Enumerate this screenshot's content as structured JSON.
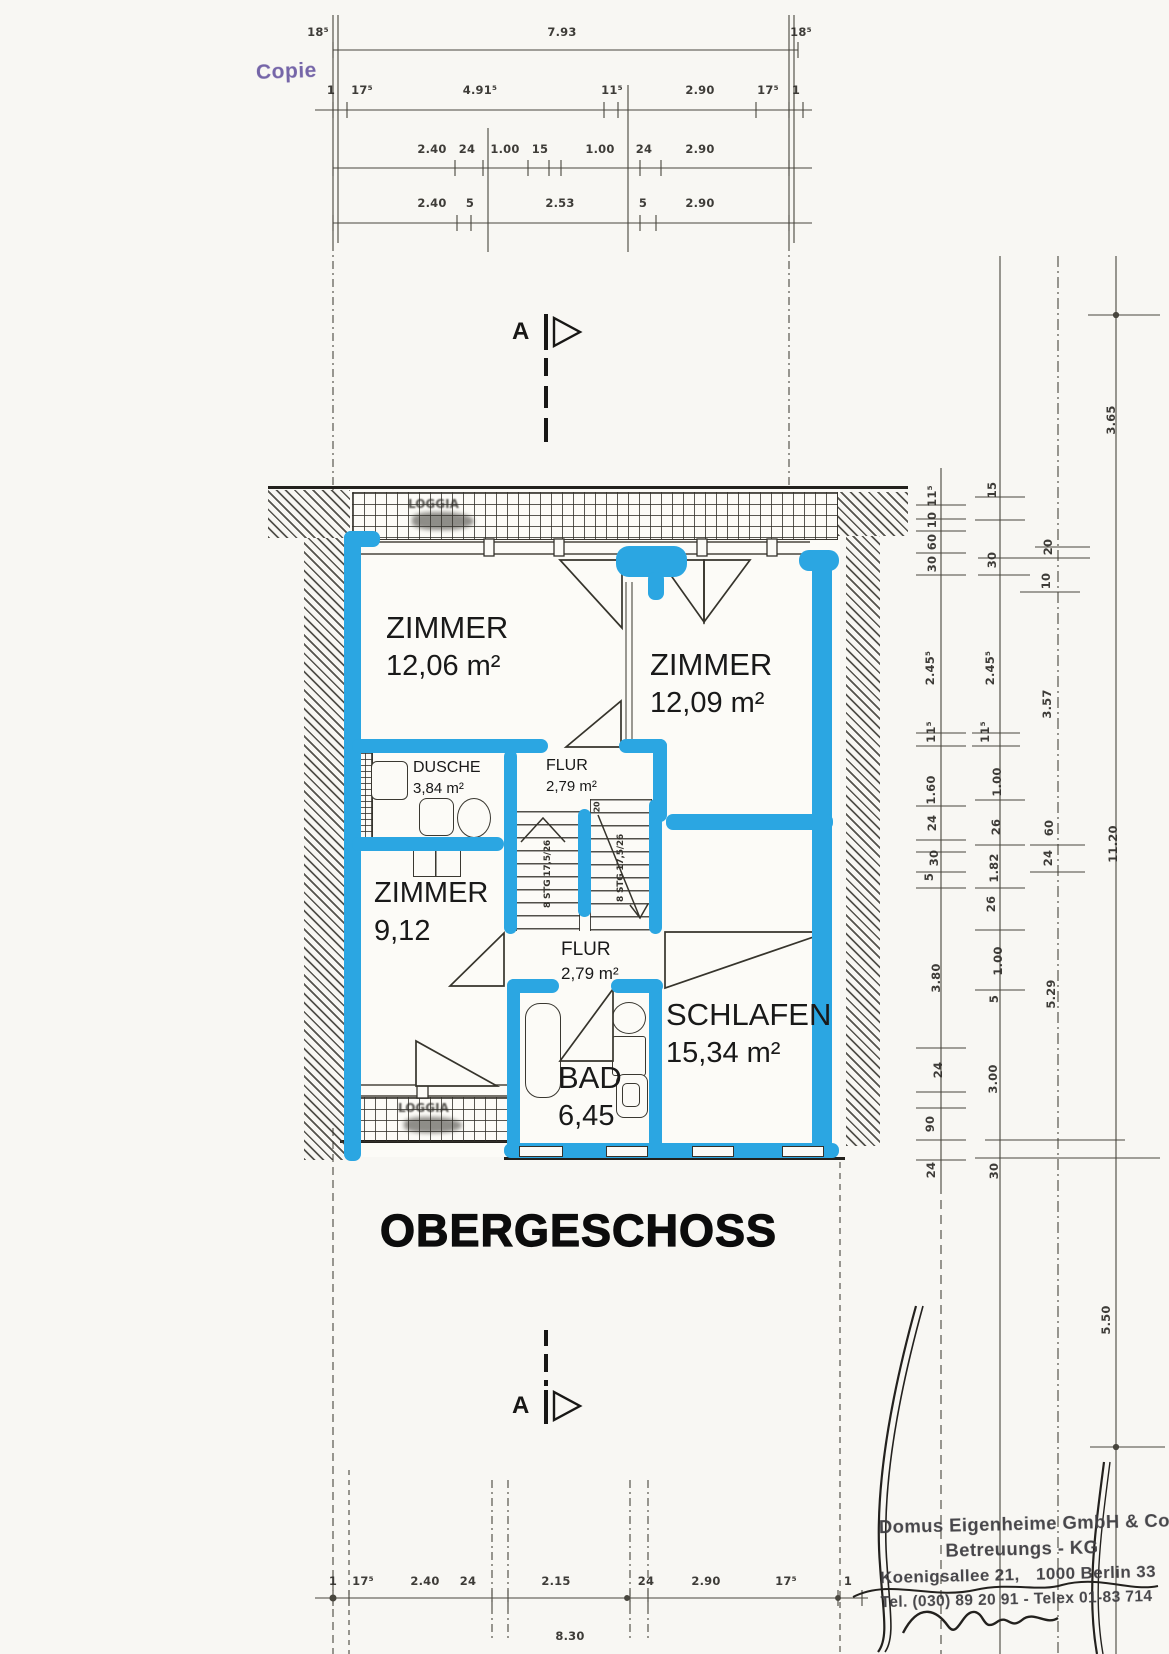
{
  "meta": {
    "copie_label": "Copie",
    "plan_title": "OBERGESCHOSS",
    "section_marker": "A"
  },
  "colors": {
    "highlight_blue": "#2ba6e2",
    "copie_purple": "#7565a8",
    "ink": "#34322c"
  },
  "rooms": {
    "zimmer1": {
      "name": "ZIMMER",
      "area": "12,06 m²"
    },
    "zimmer2": {
      "name": "ZIMMER",
      "area": "12,09 m²"
    },
    "dusche": {
      "name": "DUSCHE",
      "area": "3,84 m²"
    },
    "flur1": {
      "name": "FLUR",
      "area": "2,79 m²"
    },
    "zimmer3": {
      "name": "ZIMMER",
      "area": "9,12"
    },
    "flur2": {
      "name": "FLUR",
      "area": "2,79 m²"
    },
    "schlafen": {
      "name": "SCHLAFEN",
      "area": "15,34 m²"
    },
    "bad": {
      "name": "BAD",
      "area": "6,45"
    }
  },
  "loggia": {
    "top_label": "LOGGIA",
    "bottom_label": "LOGGIA",
    "unit": "m²"
  },
  "stairs": {
    "flight1": "8 STG 17,5/26",
    "flight2": "8 STG 17,5/26",
    "tread_note": "20"
  },
  "dims": {
    "top_labels": [
      {
        "x": 318,
        "y": 32,
        "t": "18⁵"
      },
      {
        "x": 562,
        "y": 32,
        "t": "7.93"
      },
      {
        "x": 801,
        "y": 32,
        "t": "18⁵"
      },
      {
        "x": 331,
        "y": 90,
        "t": "1"
      },
      {
        "x": 362,
        "y": 90,
        "t": "17⁵"
      },
      {
        "x": 480,
        "y": 90,
        "t": "4.91⁵"
      },
      {
        "x": 612,
        "y": 90,
        "t": "11⁵"
      },
      {
        "x": 700,
        "y": 90,
        "t": "2.90"
      },
      {
        "x": 768,
        "y": 90,
        "t": "17⁵"
      },
      {
        "x": 796,
        "y": 90,
        "t": "1"
      },
      {
        "x": 432,
        "y": 149,
        "t": "2.40"
      },
      {
        "x": 467,
        "y": 149,
        "t": "24"
      },
      {
        "x": 505,
        "y": 149,
        "t": "1.00"
      },
      {
        "x": 540,
        "y": 149,
        "t": "15"
      },
      {
        "x": 600,
        "y": 149,
        "t": "1.00"
      },
      {
        "x": 644,
        "y": 149,
        "t": "24"
      },
      {
        "x": 700,
        "y": 149,
        "t": "2.90"
      },
      {
        "x": 432,
        "y": 203,
        "t": "2.40"
      },
      {
        "x": 470,
        "y": 203,
        "t": "5"
      },
      {
        "x": 560,
        "y": 203,
        "t": "2.53"
      },
      {
        "x": 643,
        "y": 203,
        "t": "5"
      },
      {
        "x": 700,
        "y": 203,
        "t": "2.90"
      }
    ],
    "right_labels": [
      {
        "x": 932,
        "y": 496,
        "t": "11⁵"
      },
      {
        "x": 932,
        "y": 520,
        "t": "10"
      },
      {
        "x": 932,
        "y": 542,
        "t": "60"
      },
      {
        "x": 932,
        "y": 564,
        "t": "30"
      },
      {
        "x": 930,
        "y": 668,
        "t": "2.45⁵"
      },
      {
        "x": 931,
        "y": 732,
        "t": "11⁵"
      },
      {
        "x": 931,
        "y": 790,
        "t": "1.60"
      },
      {
        "x": 932,
        "y": 823,
        "t": "24"
      },
      {
        "x": 934,
        "y": 858,
        "t": "30"
      },
      {
        "x": 929,
        "y": 877,
        "t": "5"
      },
      {
        "x": 936,
        "y": 978,
        "t": "3.80"
      },
      {
        "x": 938,
        "y": 1070,
        "t": "24"
      },
      {
        "x": 930,
        "y": 1124,
        "t": "90"
      },
      {
        "x": 931,
        "y": 1170,
        "t": "24"
      },
      {
        "x": 992,
        "y": 490,
        "t": "15"
      },
      {
        "x": 992,
        "y": 560,
        "t": "30"
      },
      {
        "x": 990,
        "y": 668,
        "t": "2.45⁵"
      },
      {
        "x": 985,
        "y": 732,
        "t": "11⁵"
      },
      {
        "x": 997,
        "y": 782,
        "t": "1.00"
      },
      {
        "x": 996,
        "y": 827,
        "t": "26"
      },
      {
        "x": 994,
        "y": 868,
        "t": "1.82"
      },
      {
        "x": 991,
        "y": 904,
        "t": "26"
      },
      {
        "x": 998,
        "y": 961,
        "t": "1.00"
      },
      {
        "x": 994,
        "y": 999,
        "t": "5"
      },
      {
        "x": 993,
        "y": 1079,
        "t": "3.00"
      },
      {
        "x": 994,
        "y": 1171,
        "t": "30"
      },
      {
        "x": 1048,
        "y": 547,
        "t": "20"
      },
      {
        "x": 1046,
        "y": 581,
        "t": "10"
      },
      {
        "x": 1047,
        "y": 704,
        "t": "3.57"
      },
      {
        "x": 1049,
        "y": 828,
        "t": "60"
      },
      {
        "x": 1048,
        "y": 858,
        "t": "24"
      },
      {
        "x": 1051,
        "y": 994,
        "t": "5.29"
      },
      {
        "x": 1111,
        "y": 420,
        "t": "3.65"
      },
      {
        "x": 1113,
        "y": 844,
        "t": "11.20"
      },
      {
        "x": 1106,
        "y": 1320,
        "t": "5.50"
      }
    ],
    "bottom_labels": [
      {
        "x": 333,
        "y": 1581,
        "t": "1"
      },
      {
        "x": 363,
        "y": 1581,
        "t": "17⁵"
      },
      {
        "x": 425,
        "y": 1581,
        "t": "2.40"
      },
      {
        "x": 468,
        "y": 1581,
        "t": "24"
      },
      {
        "x": 556,
        "y": 1581,
        "t": "2.15"
      },
      {
        "x": 646,
        "y": 1581,
        "t": "24"
      },
      {
        "x": 706,
        "y": 1581,
        "t": "2.90"
      },
      {
        "x": 786,
        "y": 1581,
        "t": "17⁵"
      },
      {
        "x": 848,
        "y": 1581,
        "t": "1"
      },
      {
        "x": 570,
        "y": 1636,
        "t": "8.30"
      }
    ]
  },
  "stamp": {
    "line1": "Domus Eigenheime GmbH & Co.",
    "line2": "Betreuungs - KG",
    "line3a": "Koenigsallee 21,",
    "line3b": "1000 Berlin 33",
    "line4": "Tel. (030) 89 20 91 - Telex 01-83 714"
  }
}
